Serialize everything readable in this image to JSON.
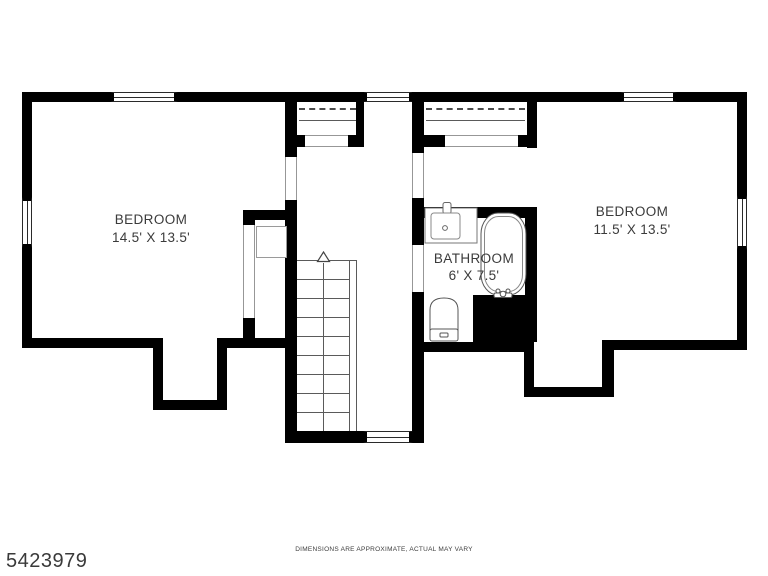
{
  "plan": {
    "rooms": {
      "bedroom_left": {
        "name": "BEDROOM",
        "dims": "14.5' X 13.5'"
      },
      "bedroom_right": {
        "name": "BEDROOM",
        "dims": "11.5' X 13.5'"
      },
      "bathroom": {
        "name": "BATHROOM",
        "dims": "6' X 7.5'"
      }
    },
    "stairs": {
      "direction": "up"
    },
    "fixtures": [
      "sink",
      "bathtub",
      "toilet"
    ],
    "colors": {
      "wall": "#000000",
      "background": "#ffffff",
      "text": "#3b3b3b",
      "fixture_line": "#555555"
    }
  },
  "footer": {
    "listing_id": "5423979",
    "disclaimer": "DIMENSIONS ARE APPROXIMATE, ACTUAL MAY VARY"
  }
}
